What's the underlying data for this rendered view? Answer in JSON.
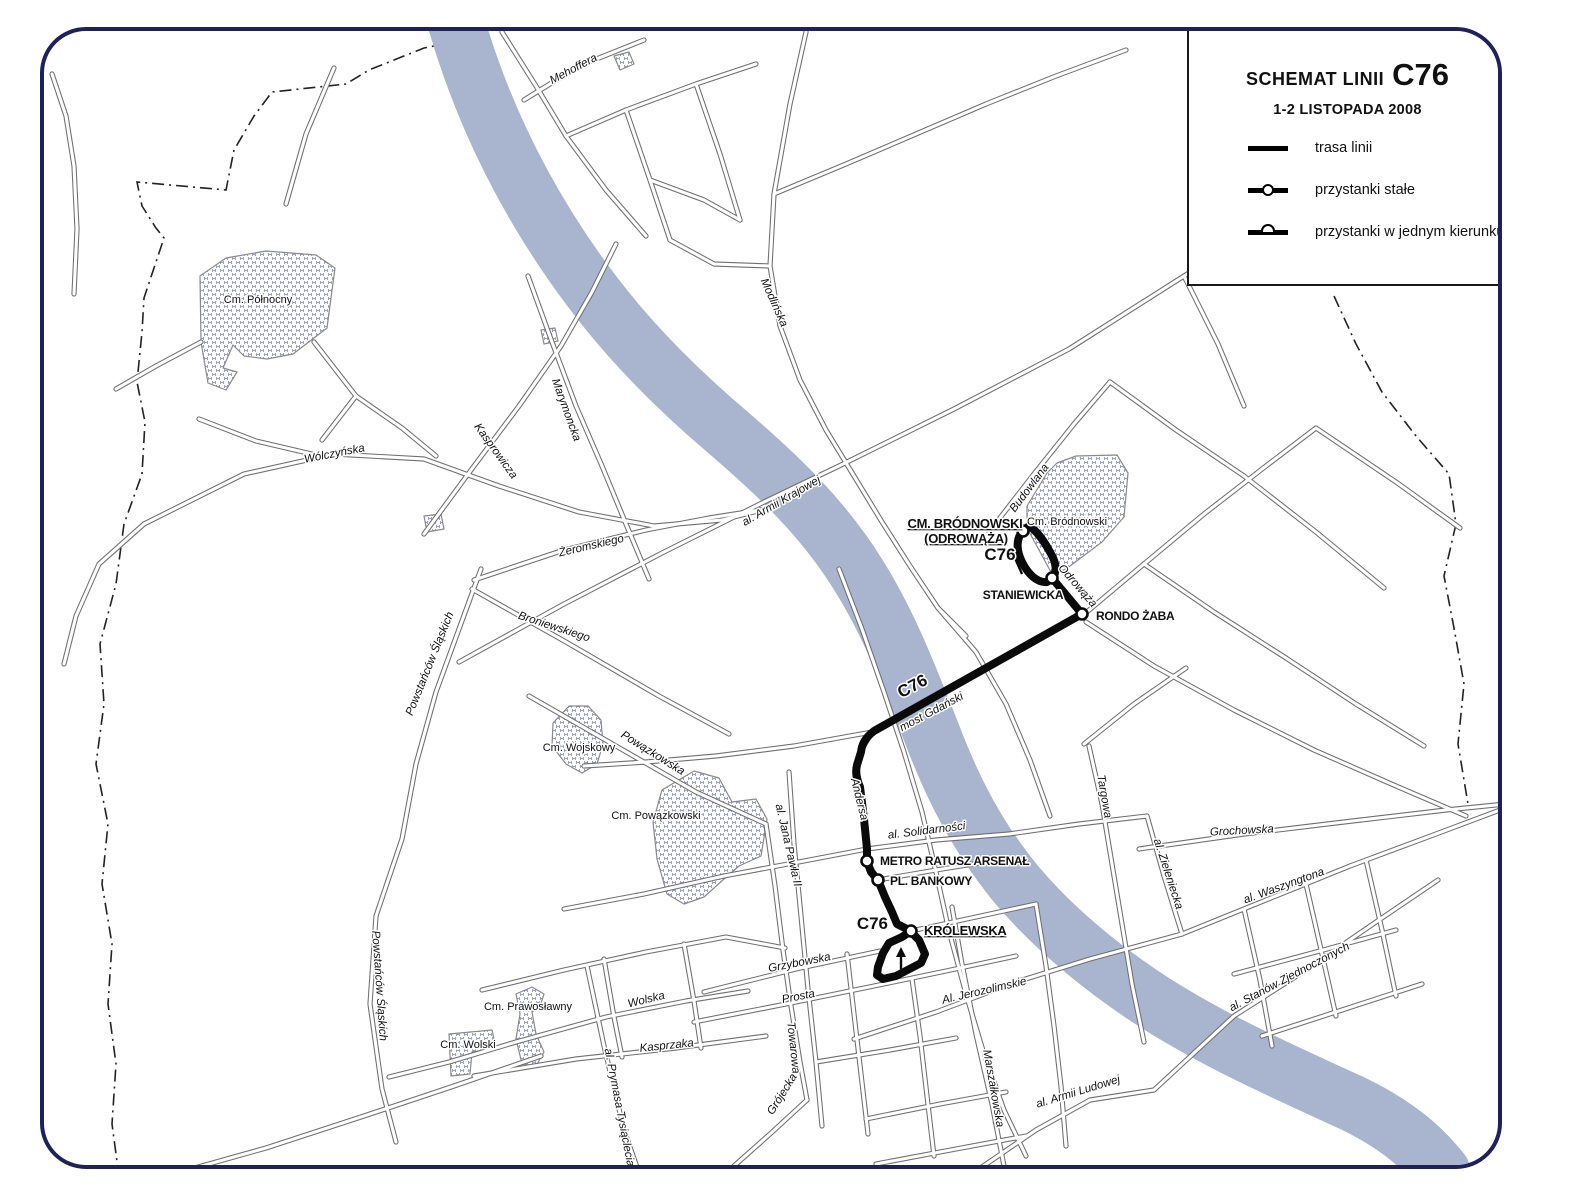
{
  "header": {
    "title_prefix": "SCHEMAT LINII",
    "line_number": "C76",
    "subtitle": "1-2 LISTOPADA 2008"
  },
  "legend": {
    "items": [
      {
        "symbol": "route-line",
        "label": "trasa linii"
      },
      {
        "symbol": "stop-regular",
        "label": "przystanki stałe"
      },
      {
        "symbol": "stop-oneway",
        "label": "przystanki w jednym kierunku"
      }
    ]
  },
  "map": {
    "colors": {
      "river": "#a9b5ce",
      "route": "#0a0a0a",
      "street_casing": "#6f6f6f",
      "street_fill": "#ffffff",
      "cemetery_hatch": "#9ba1c7",
      "page_border": "#20205a"
    },
    "stops": [
      {
        "name": "CM. BRÓDNOWSKI (ODROWĄŻA)",
        "x": 1019,
        "y": 527,
        "terminus": true
      },
      {
        "name": "STANIEWICKA",
        "x": 1048,
        "y": 574,
        "terminus": false
      },
      {
        "name": "RONDO ŻABA",
        "x": 1078,
        "y": 610,
        "terminus": false
      },
      {
        "name": "METRO RATUSZ ARSENAŁ",
        "x": 863,
        "y": 857,
        "terminus": false
      },
      {
        "name": "PL. BANKOWY",
        "x": 874,
        "y": 876,
        "terminus": false
      },
      {
        "name": "KRÓLEWSKA",
        "x": 907,
        "y": 927,
        "terminus": true
      }
    ],
    "labels": [
      {
        "text": "CM. BRÓDNOWSKI",
        "x": 961,
        "y": 524,
        "cls": "stop-terminus"
      },
      {
        "text": "(ODROWĄŻA)",
        "x": 962,
        "y": 539,
        "cls": "stop-terminus"
      },
      {
        "text": "STANIEWICKA",
        "x": 1019,
        "y": 595,
        "cls": "stop"
      },
      {
        "text": "RONDO ŻABA",
        "x": 1092,
        "y": 616,
        "cls": "stop",
        "anchor": "start"
      },
      {
        "text": "METRO RATUSZ ARSENAŁ",
        "x": 876,
        "y": 861,
        "cls": "stop",
        "anchor": "start"
      },
      {
        "text": "PL. BANKOWY",
        "x": 886,
        "y": 881,
        "cls": "stop",
        "anchor": "start"
      },
      {
        "text": "KRÓLEWSKA",
        "x": 920,
        "y": 931,
        "cls": "stop-terminus",
        "anchor": "start"
      },
      {
        "text": "C76",
        "x": 996,
        "y": 556,
        "cls": "route-badge"
      },
      {
        "text": "C76",
        "x": 884,
        "y": 925,
        "cls": "route-badge",
        "anchor": "end"
      },
      {
        "text": "C76",
        "x": 911,
        "y": 687,
        "cls": "route-badge",
        "rot": -28
      },
      {
        "text": "Cm. Północny",
        "x": 254,
        "y": 299,
        "cls": "cemetery"
      },
      {
        "text": "Cm. Bródnowski",
        "x": 1063,
        "y": 521,
        "cls": "cemetery"
      },
      {
        "text": "Cm. Wojskowy",
        "x": 575,
        "y": 747,
        "cls": "cemetery"
      },
      {
        "text": "Cm. Powązkowski",
        "x": 652,
        "y": 815,
        "cls": "cemetery"
      },
      {
        "text": "Cm. Prawosławny",
        "x": 524,
        "y": 1006,
        "cls": "cemetery"
      },
      {
        "text": "Cm. Wolski",
        "x": 464,
        "y": 1044,
        "cls": "cemetery"
      },
      {
        "text": "Mehoffera",
        "x": 571,
        "y": 68,
        "rot": -28,
        "cls": "street"
      },
      {
        "text": "Modlińska",
        "x": 767,
        "y": 300,
        "rot": 66,
        "cls": "street"
      },
      {
        "text": "al. Armii Krajowej",
        "x": 779,
        "y": 500,
        "rot": -30,
        "cls": "street"
      },
      {
        "text": "Wólczyńska",
        "x": 331,
        "y": 453,
        "rot": -11,
        "cls": "street"
      },
      {
        "text": "Kasprowicza",
        "x": 489,
        "y": 449,
        "rot": 54,
        "cls": "street"
      },
      {
        "text": "Marymoncka",
        "x": 559,
        "y": 407,
        "rot": 70,
        "cls": "street"
      },
      {
        "text": "Żeromskiego",
        "x": 588,
        "y": 545,
        "rot": -13,
        "cls": "street"
      },
      {
        "text": "Broniewskiego",
        "x": 549,
        "y": 626,
        "rot": 18,
        "cls": "street"
      },
      {
        "text": "Powstańców Śląskich",
        "x": 429,
        "y": 661,
        "rot": -68,
        "cls": "street"
      },
      {
        "text": "Powstańców Śląskich",
        "x": 372,
        "y": 982,
        "rot": 86,
        "cls": "street"
      },
      {
        "text": "Powązkowska",
        "x": 647,
        "y": 752,
        "rot": 32,
        "cls": "street"
      },
      {
        "text": "al. Jana Pawła II",
        "x": 781,
        "y": 842,
        "rot": 77,
        "cls": "street"
      },
      {
        "text": "Andersa",
        "x": 852,
        "y": 796,
        "rot": 76,
        "cls": "street"
      },
      {
        "text": "al. Solidarności",
        "x": 923,
        "y": 830,
        "rot": -7,
        "cls": "street"
      },
      {
        "text": "most Gdański",
        "x": 929,
        "y": 711,
        "rot": -28,
        "cls": "street"
      },
      {
        "text": "Grzybowska",
        "x": 796,
        "y": 962,
        "rot": -11,
        "cls": "street"
      },
      {
        "text": "Prosta",
        "x": 795,
        "y": 996,
        "rot": -11,
        "cls": "street"
      },
      {
        "text": "Wolska",
        "x": 643,
        "y": 999,
        "rot": -14,
        "cls": "street"
      },
      {
        "text": "Kasprzaka",
        "x": 663,
        "y": 1045,
        "rot": -6,
        "cls": "street"
      },
      {
        "text": "al. Prymasa Tysiąclecia",
        "x": 612,
        "y": 1104,
        "rot": 79,
        "cls": "street"
      },
      {
        "text": "Towarowa",
        "x": 786,
        "y": 1044,
        "rot": 84,
        "cls": "street"
      },
      {
        "text": "Grójecka",
        "x": 781,
        "y": 1092,
        "rot": -58,
        "cls": "street"
      },
      {
        "text": "Al. Jerozolimskie",
        "x": 981,
        "y": 990,
        "rot": -13,
        "cls": "street"
      },
      {
        "text": "Marszałkowska",
        "x": 986,
        "y": 1085,
        "rot": 80,
        "cls": "street"
      },
      {
        "text": "al. Armii Ludowej",
        "x": 1075,
        "y": 1091,
        "rot": -17,
        "cls": "street"
      },
      {
        "text": "Targowa",
        "x": 1097,
        "y": 793,
        "rot": 80,
        "cls": "street"
      },
      {
        "text": "Grochowska",
        "x": 1238,
        "y": 830,
        "rot": -3,
        "cls": "street"
      },
      {
        "text": "al. Zieleniecka",
        "x": 1161,
        "y": 871,
        "rot": 72,
        "cls": "street"
      },
      {
        "text": "al. Waszyngtona",
        "x": 1281,
        "y": 885,
        "rot": -20,
        "cls": "street"
      },
      {
        "text": "al. Stanów Zjednoczonych",
        "x": 1287,
        "y": 976,
        "rot": -28,
        "cls": "street"
      },
      {
        "text": "Odrowąża",
        "x": 1071,
        "y": 584,
        "rot": 49,
        "cls": "street"
      },
      {
        "text": "Budowlana",
        "x": 1028,
        "y": 486,
        "rot": -53,
        "cls": "street"
      }
    ]
  }
}
